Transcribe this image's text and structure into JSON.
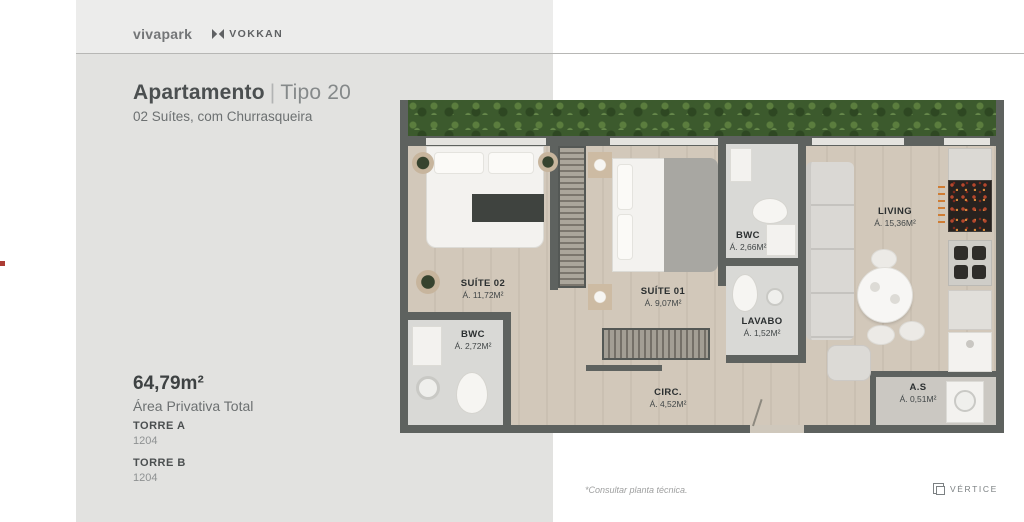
{
  "header": {
    "brand_primary": "vivapark",
    "brand_secondary": "VOKKAN"
  },
  "title": {
    "main": "Apartamento",
    "separator": "|",
    "variant": "Tipo 20",
    "subtitle": "02 Suítes, com Churrasqueira"
  },
  "details": {
    "area_value": "64,79m²",
    "area_label": "Área Privativa Total",
    "towers": [
      {
        "name": "TORRE A",
        "unit": "1204"
      },
      {
        "name": "TORRE B",
        "unit": "1204"
      }
    ]
  },
  "floorplan": {
    "rooms": [
      {
        "name": "SUÍTE 02",
        "area": "Á. 11,72M²"
      },
      {
        "name": "BWC",
        "area": "Á. 2,72M²"
      },
      {
        "name": "SUÍTE 01",
        "area": "Á. 9,07M²"
      },
      {
        "name": "BWC",
        "area": "Á. 2,66M²"
      },
      {
        "name": "LAVABO",
        "area": "Á. 1,52M²"
      },
      {
        "name": "CIRC.",
        "area": "Á. 4,52M²"
      },
      {
        "name": "LIVING",
        "area": "Á. 15,36M²"
      },
      {
        "name": "A.S",
        "area": "Á. 0,51M²"
      }
    ]
  },
  "footer": {
    "note": "*Consultar planta técnica.",
    "brand": "VÉRTICE"
  },
  "colors": {
    "marker_accent": "#ac3c35",
    "plan_wall": "#5e625f",
    "foliage_green": "#3c5a2d"
  }
}
